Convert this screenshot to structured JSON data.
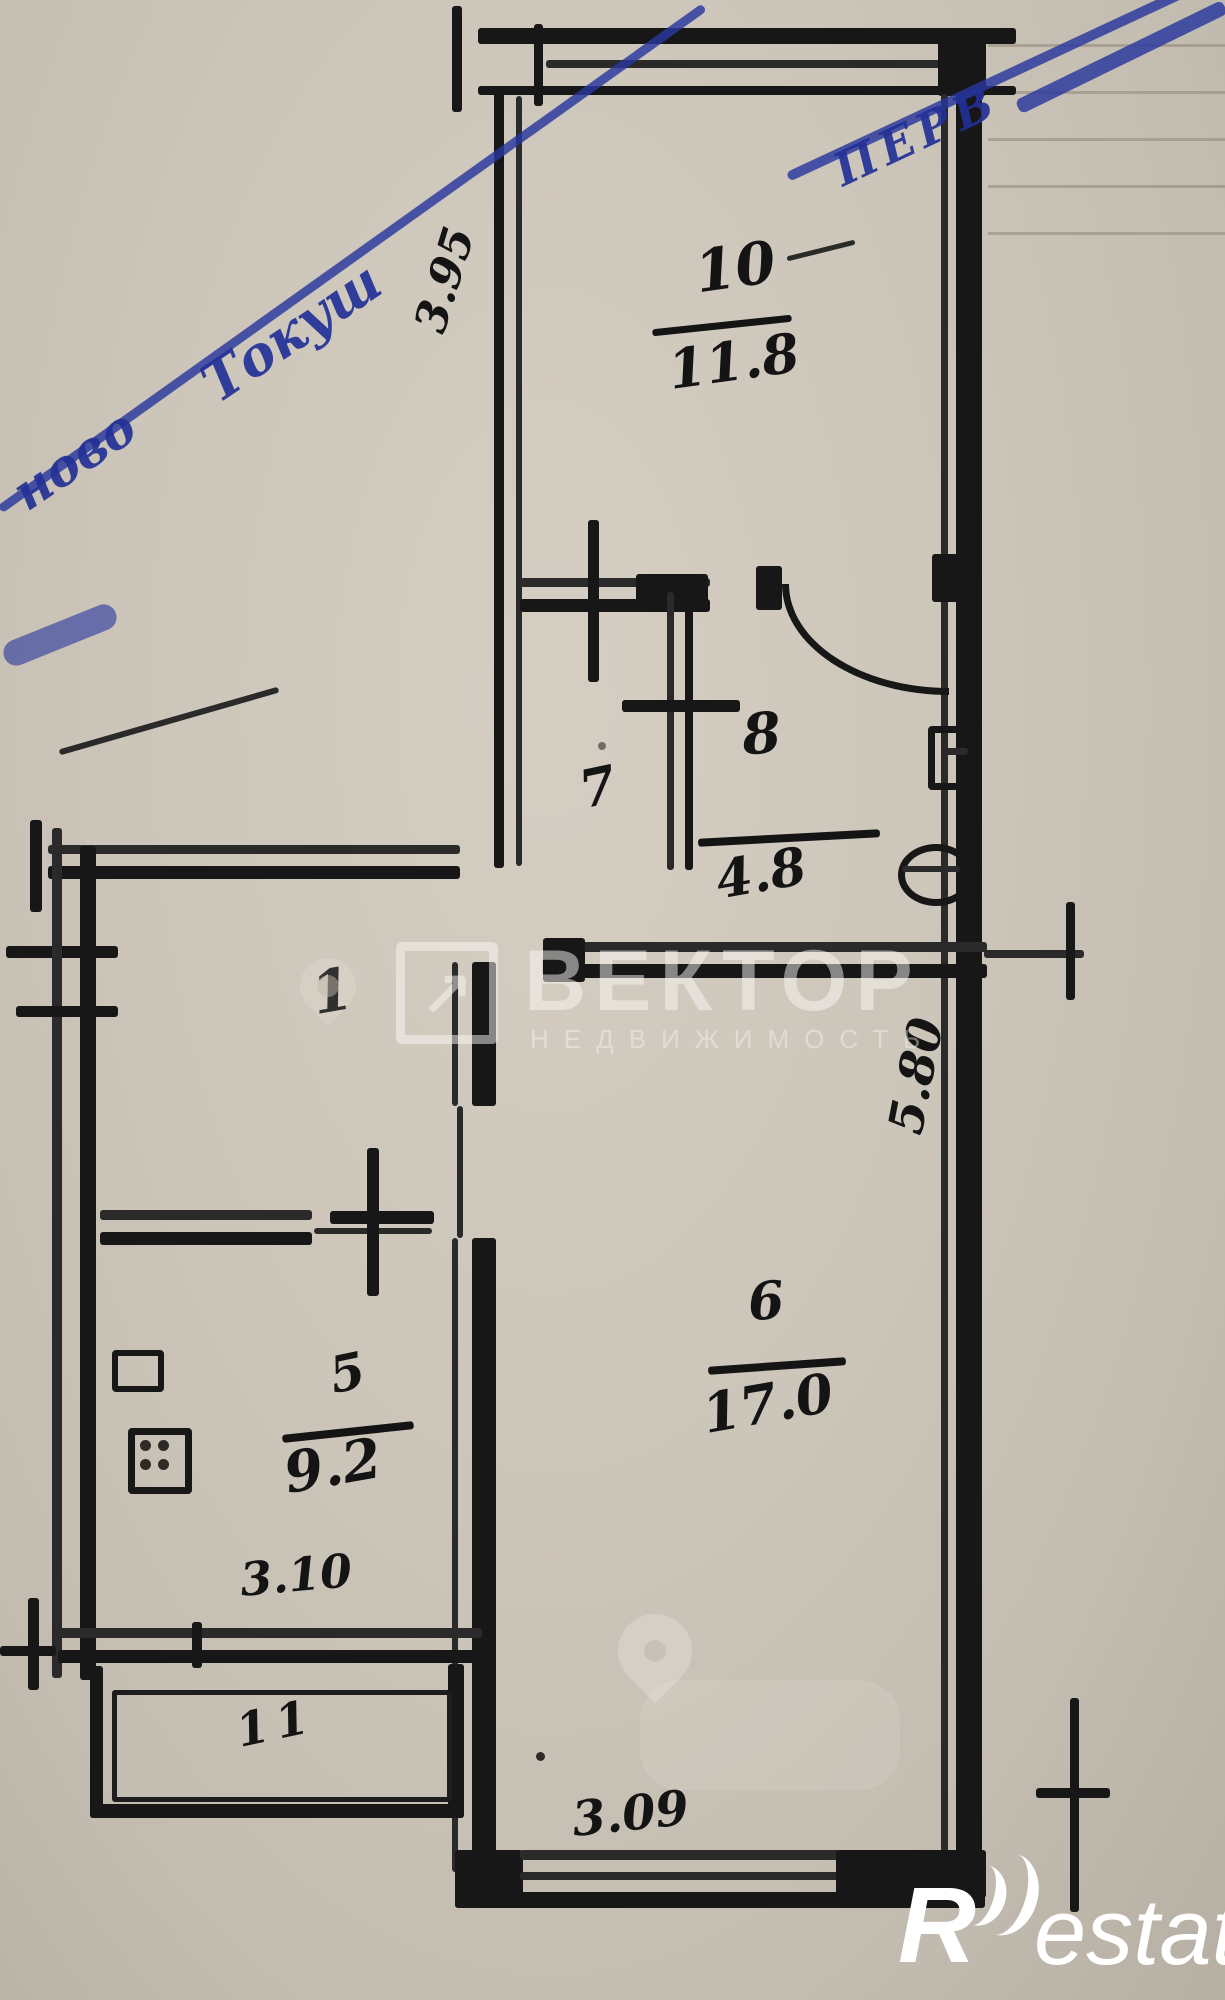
{
  "stamp": {
    "fragment_left": "ново",
    "fragment_center": "Токуш",
    "fragment_right": "ПЕРВ",
    "color": "#2837a0"
  },
  "rooms": {
    "r10": {
      "number": "10",
      "area": "11.8"
    },
    "r7": {
      "number": "7"
    },
    "r8": {
      "number": "8",
      "area": "4.8"
    },
    "r1": {
      "number": "1"
    },
    "r5": {
      "number": "5",
      "area": "9.2"
    },
    "r6": {
      "number": "6",
      "area": "17.0"
    },
    "r11": {
      "number": "11"
    }
  },
  "dimensions": {
    "room10_width": "3.95",
    "kitchen_width": "3.10",
    "room6_width": "3.09",
    "room6_height": "5.80"
  },
  "watermarks": {
    "vektor_logo_arrow": "↗",
    "vektor_name": "ВЕКТОР",
    "vektor_subtitle": "НЕДВИЖИМОСТЬ",
    "restate_r": "R",
    "restate_rest": "estate"
  },
  "colors": {
    "paper": "#ccc5b9",
    "ink": "#171717",
    "stamp_blue": "#2837a0",
    "watermark_white": "rgba(255,255,255,0.5)"
  }
}
